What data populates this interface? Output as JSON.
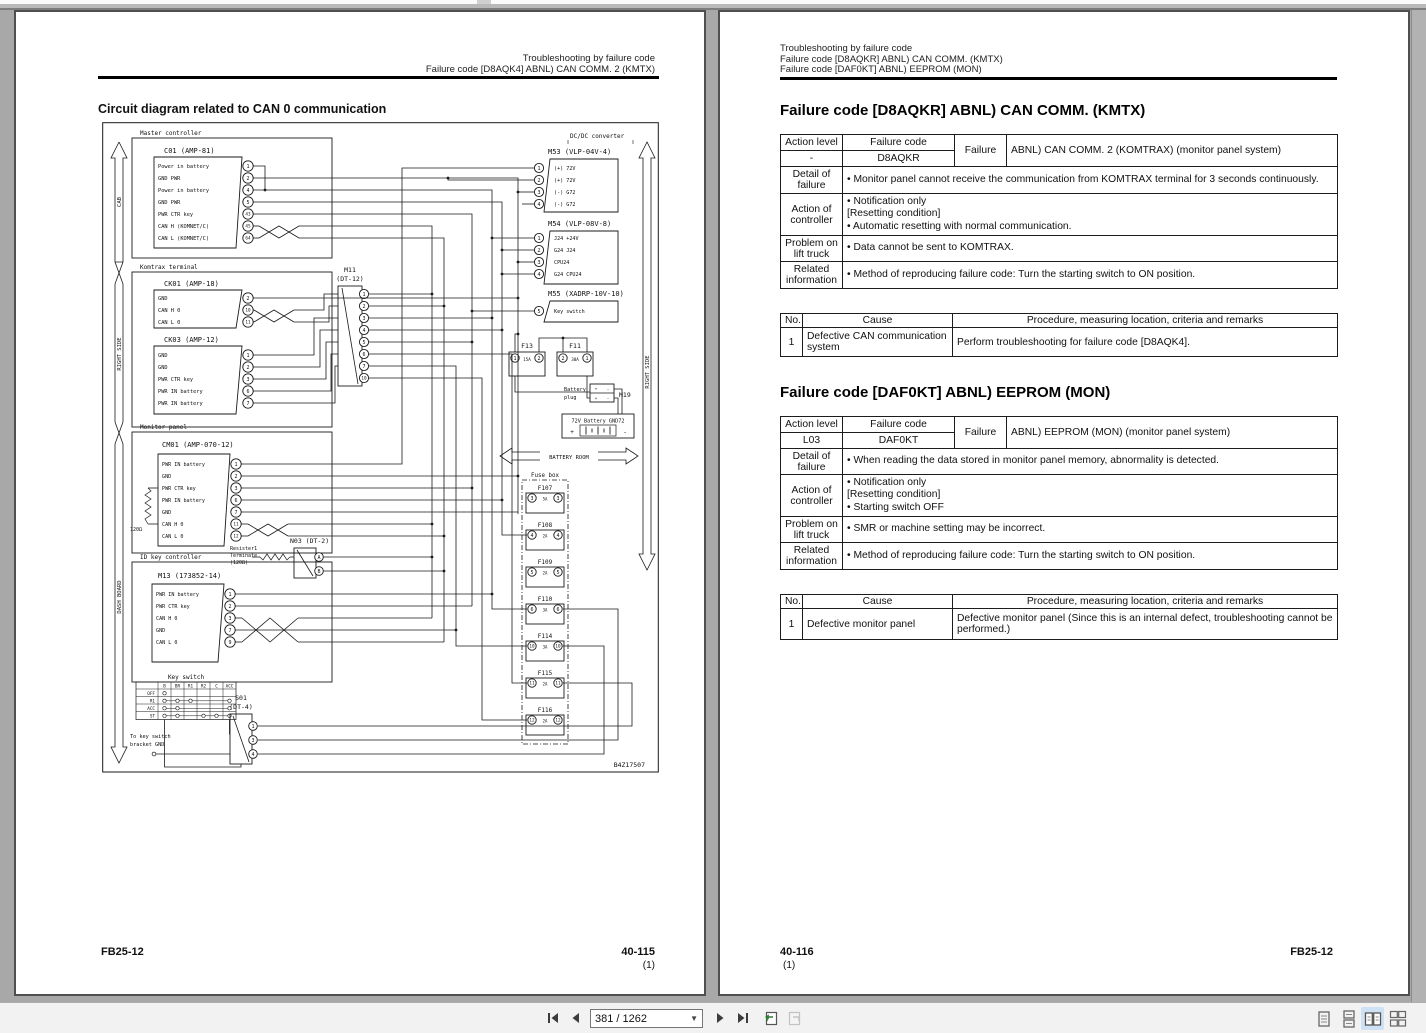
{
  "toolbar": {
    "page_indicator": "381 / 1262",
    "icons": [
      "first-page",
      "previous-page",
      "next-page",
      "last-page",
      "previous-view",
      "next-view"
    ],
    "layout_icons": [
      "single-page",
      "continuous-scroll",
      "two-page",
      "two-page-continuous"
    ],
    "active_layout": "two-page",
    "active_layout_color": "#cfe2f5"
  },
  "left_page": {
    "header": {
      "line1": "Troubleshooting by failure code",
      "line2": "Failure code [D8AQK4] ABNL) CAN COMM. 2 (KMTX)"
    },
    "title": "Circuit diagram related to CAN 0 communication",
    "footer": {
      "doc": "FB25-12",
      "page": "40-115",
      "sub": "(1)"
    },
    "diagram": {
      "ref": "B4Z17507",
      "side": {
        "cab": "CAB",
        "right1": "RIGHT SIDE",
        "dash": "DASH BOARD",
        "right2": "RIGHT SIDE"
      },
      "master": {
        "label": "Master controller",
        "name": "C01 (AMP-81)",
        "pins": [
          {
            "t": "Power in battery",
            "n": "1"
          },
          {
            "t": "GND PWR",
            "n": "2"
          },
          {
            "t": "Power in battery",
            "n": "4"
          },
          {
            "t": "GND PWR",
            "n": "5"
          },
          {
            "t": "PWR CTR key",
            "n": "43"
          },
          {
            "t": "CAN H (KOMNET/C)",
            "n": "45"
          },
          {
            "t": "CAN L (KOMNET/C)",
            "n": "64"
          }
        ]
      },
      "komtrax": {
        "label": "Komtrax terminal",
        "ck01": {
          "name": "CK01 (AMP-18)",
          "pins": [
            {
              "t": "GND",
              "n": "2"
            },
            {
              "t": "CAN H 0",
              "n": "10"
            },
            {
              "t": "CAN L 0",
              "n": "11"
            }
          ]
        },
        "ck03": {
          "name": "CK03 (AMP-12)",
          "pins": [
            {
              "t": "GND",
              "n": "1"
            },
            {
              "t": "GND",
              "n": "2"
            },
            {
              "t": "PWR CTR key",
              "n": "3"
            },
            {
              "t": "PWR IN battery",
              "n": "6"
            },
            {
              "t": "PWR IN battery",
              "n": "7"
            }
          ]
        }
      },
      "monitor": {
        "label": "Monitor panel",
        "name": "CM01 (AMP-070-12)",
        "resistor": "120Ω",
        "pins": [
          {
            "t": "PWR IN battery",
            "n": "1"
          },
          {
            "t": "GND",
            "n": "2"
          },
          {
            "t": "PWR CTR key",
            "n": "3"
          },
          {
            "t": "PWR IN battery",
            "n": "6"
          },
          {
            "t": "GND",
            "n": "7"
          },
          {
            "t": "CAN H 0",
            "n": "11"
          },
          {
            "t": "CAN L 0",
            "n": "12"
          }
        ]
      },
      "idkey": {
        "label": "ID key controller",
        "name": "M13 (173852-14)",
        "pins": [
          {
            "t": "PWR IN battery",
            "n": "1"
          },
          {
            "t": "PWR CTR key",
            "n": "2"
          },
          {
            "t": "CAN H 0",
            "n": "3"
          },
          {
            "t": "GND",
            "n": "7"
          },
          {
            "t": "CAN L 0",
            "n": "9"
          }
        ]
      },
      "m11": {
        "name1": "M11",
        "name2": "(DT-12)",
        "pins": [
          "1",
          "2",
          "3",
          "4",
          "5",
          "6",
          "7",
          "10"
        ]
      },
      "n03": {
        "name": "N03 (DT-2)",
        "note1": "Resister1",
        "note2": "Terminate",
        "note3": "(120Ω)",
        "pins": [
          "A",
          "B"
        ]
      },
      "keyswitch": {
        "title": "Key switch",
        "cols": [
          "B",
          "BR",
          "R1",
          "R2",
          "C",
          "ACC"
        ],
        "rows": [
          "OFF",
          "R1",
          "ACC",
          "ST"
        ]
      },
      "s01": {
        "name1": "S01",
        "name2": "(DT-4)",
        "pins": [
          "1",
          "3",
          "4"
        ],
        "note1": "To key switch",
        "note2": "bracket GND"
      },
      "dcdc": {
        "label": "DC/DC converter",
        "m53": {
          "name": "M53 (VLP-04V-4)",
          "pins": [
            {
              "n": "1",
              "t": "(+) 72V"
            },
            {
              "n": "2",
              "t": "(+) 72V"
            },
            {
              "n": "3",
              "t": "(-) G72"
            },
            {
              "n": "4",
              "t": "(-) G72"
            }
          ]
        },
        "m54": {
          "name": "M54 (VLP-08V-8)",
          "pins": [
            {
              "n": "1",
              "t": "J24 +24V"
            },
            {
              "n": "2",
              "t": "G24 J24"
            },
            {
              "n": "3",
              "t": "CPU24"
            },
            {
              "n": "4",
              "t": "G24 CPU24"
            }
          ]
        },
        "m55": {
          "name": "M55 (XADRP-10V-10)",
          "pins": [
            {
              "n": "5",
              "t": "Key switch"
            }
          ]
        }
      },
      "f13": {
        "name": "F13",
        "a": "1",
        "b": "2",
        "rating": "15A"
      },
      "f11": {
        "name": "F11",
        "a": "2",
        "b": "1",
        "rating": "30A"
      },
      "battery": {
        "plug1": "Battery",
        "plug2": "plug",
        "m19": "M19",
        "label": "72V Battery GND72",
        "room": "BATTERY ROOM"
      },
      "fusebox": {
        "title": "Fuse box",
        "fuses": [
          {
            "name": "F107",
            "pin": "3",
            "rating": "5A"
          },
          {
            "name": "F108",
            "pin": "4",
            "rating": "2A"
          },
          {
            "name": "F109",
            "pin": "5",
            "rating": "2A"
          },
          {
            "name": "F110",
            "pin": "6",
            "rating": "3A"
          },
          {
            "name": "F114",
            "pin": "10",
            "rating": "3A"
          },
          {
            "name": "F115",
            "pin": "11",
            "rating": "2A"
          },
          {
            "name": "F116",
            "pin": "12",
            "rating": "2A"
          }
        ]
      }
    }
  },
  "right_page": {
    "header": {
      "line1": "Troubleshooting by failure code",
      "line2": "Failure code [D8AQKR] ABNL) CAN COMM. (KMTX)",
      "line3": "Failure code [DAF0KT] ABNL) EEPROM (MON)"
    },
    "sections": [
      {
        "title": "Failure code [D8AQKR] ABNL) CAN COMM. (KMTX)",
        "info": {
          "action_level_label": "Action level",
          "failure_code_label": "Failure code",
          "failure_label": "Failure",
          "action_level": "-",
          "failure_code": "D8AQKR",
          "failure_desc": "ABNL) CAN COMM. 2 (KOMTRAX) (monitor panel system)",
          "rows": [
            {
              "label": "Detail of failure",
              "lines": [
                "•  Monitor panel cannot receive the communication from KOMTRAX terminal for 3 seconds continuously."
              ]
            },
            {
              "label": "Action of controller",
              "lines": [
                "•  Notification only",
                "[Resetting condition]",
                "•  Automatic resetting with normal communication."
              ]
            },
            {
              "label": "Problem on lift truck",
              "lines": [
                "•  Data cannot be sent to KOMTRAX."
              ]
            },
            {
              "label": "Related information",
              "lines": [
                "•  Method of reproducing failure code: Turn the starting switch to ON position."
              ]
            }
          ]
        },
        "causes": {
          "no_h": "No.",
          "cause_h": "Cause",
          "proc_h": "Procedure, measuring location, criteria and remarks",
          "rows": [
            {
              "no": "1",
              "cause": "Defective CAN communication system",
              "proc": "Perform troubleshooting for failure code [D8AQK4]."
            }
          ]
        }
      },
      {
        "title": "Failure code [DAF0KT] ABNL) EEPROM (MON)",
        "info": {
          "action_level_label": "Action level",
          "failure_code_label": "Failure code",
          "failure_label": "Failure",
          "action_level": "L03",
          "failure_code": "DAF0KT",
          "failure_desc": "ABNL) EEPROM (MON) (monitor panel system)",
          "rows": [
            {
              "label": "Detail of failure",
              "lines": [
                "•  When reading the data stored in monitor panel memory, abnormality is detected."
              ]
            },
            {
              "label": "Action of controller",
              "lines": [
                "•  Notification only",
                "[Resetting condition]",
                "•  Starting switch OFF"
              ]
            },
            {
              "label": "Problem on lift truck",
              "lines": [
                "•  SMR or machine setting may be incorrect."
              ]
            },
            {
              "label": "Related information",
              "lines": [
                "•  Method of reproducing failure code: Turn the starting switch to ON position."
              ]
            }
          ]
        },
        "causes": {
          "no_h": "No.",
          "cause_h": "Cause",
          "proc_h": "Procedure, measuring location, criteria and remarks",
          "rows": [
            {
              "no": "1",
              "cause": "Defective monitor panel",
              "proc": "Defective monitor panel (Since this is an internal defect, troubleshooting cannot be performed.)"
            }
          ]
        }
      }
    ],
    "footer": {
      "page": "40-116",
      "sub": "(1)",
      "doc": "FB25-12"
    }
  }
}
